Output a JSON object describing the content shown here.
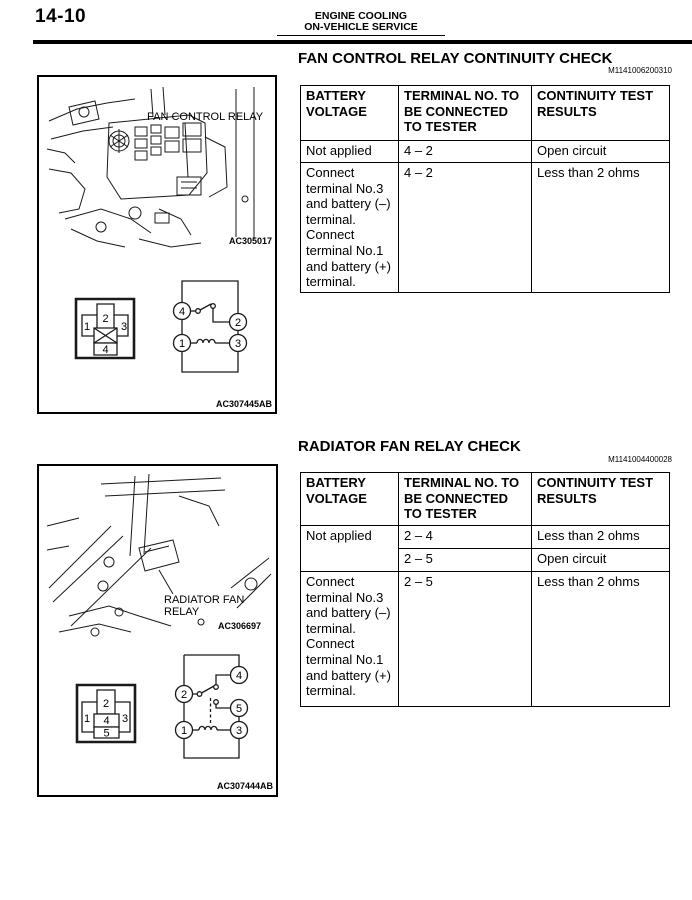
{
  "page": {
    "number": "14-10",
    "header_title": "ENGINE COOLING",
    "header_subtitle": "ON-VEHICLE SERVICE"
  },
  "sections": [
    {
      "title": "FAN CONTROL RELAY CONTINUITY CHECK",
      "ref_code": "M1141006200310",
      "figure": {
        "callout": "FAN CONTROL RELAY",
        "art_code": "AC305017",
        "diagram_code": "AC307445AB",
        "connector_pins": {
          "top": "2",
          "left": "1",
          "right": "3",
          "bottom": "4"
        },
        "circuit_pins": {
          "switch_in": "4",
          "switch_out": "2",
          "coil_in": "1",
          "coil_out": "3"
        }
      },
      "table": {
        "headers": [
          "BATTERY VOLTAGE",
          "TERMINAL NO. TO BE CONNECTED TO TESTER",
          "CONTINUITY TEST RESULTS"
        ],
        "rows": [
          {
            "voltage": "Not applied",
            "terminals": "4 – 2",
            "result": "Open circuit"
          },
          {
            "voltage": "Connect terminal No.3 and battery (–) terminal. Connect terminal No.1 and battery (+) terminal.",
            "terminals": "4 – 2",
            "result": "Less than 2 ohms"
          }
        ]
      }
    },
    {
      "title": "RADIATOR FAN RELAY CHECK",
      "ref_code": "M1141004400028",
      "figure": {
        "callout_line1": "RADIATOR FAN",
        "callout_line2": "RELAY",
        "art_code": "AC306697",
        "diagram_code": "AC307444AB",
        "connector_pins": {
          "top": "2",
          "left": "1",
          "right": "3",
          "mid": "4",
          "bottom": "5"
        },
        "circuit_pins": {
          "switch_in": "2",
          "contact_a": "4",
          "contact_b": "5",
          "coil_in": "1",
          "coil_out": "3"
        }
      },
      "table": {
        "headers": [
          "BATTERY VOLTAGE",
          "TERMINAL NO. TO BE CONNECTED TO TESTER",
          "CONTINUITY TEST RESULTS"
        ],
        "rows": [
          {
            "voltage": "Not applied",
            "terminals": "2 – 4",
            "result": "Less than 2 ohms"
          },
          {
            "terminals": "2 – 5",
            "result": "Open circuit"
          },
          {
            "voltage": "Connect terminal No.3 and battery (–) terminal. Connect terminal No.1 and battery (+) terminal.",
            "terminals": "2 – 5",
            "result": "Less than 2 ohms"
          }
        ]
      }
    }
  ]
}
